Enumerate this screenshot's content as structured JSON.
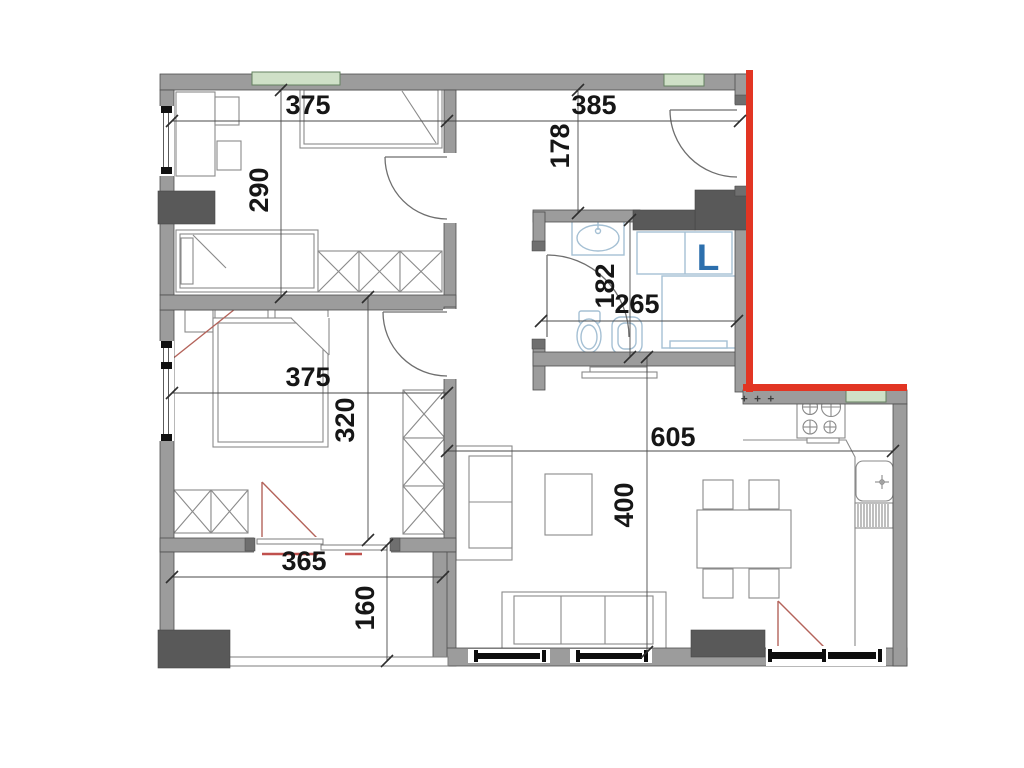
{
  "floorplan": {
    "colors": {
      "wall_gray": "#9c9c9c",
      "dark_gray": "#595959",
      "highlight_red": "#e23523",
      "swing_red": "#b4635a",
      "window_green": "#cfe0c7",
      "fixture_blue": "#a5c0d4",
      "label_blue": "#2c6fad"
    },
    "dimensions": {
      "kids_room_width": "375",
      "kids_room_height": "290",
      "hall_width": "385",
      "hall_height": "178",
      "bathroom_height": "182",
      "bathroom_width": "265",
      "master_room_width": "375",
      "master_room_height": "320",
      "living_room_width": "605",
      "living_room_height": "400",
      "balcony_width": "365",
      "balcony_height": "160"
    },
    "labels": {
      "laundry_marker": "L",
      "kitchen_vent_marks": "+ + +"
    }
  }
}
